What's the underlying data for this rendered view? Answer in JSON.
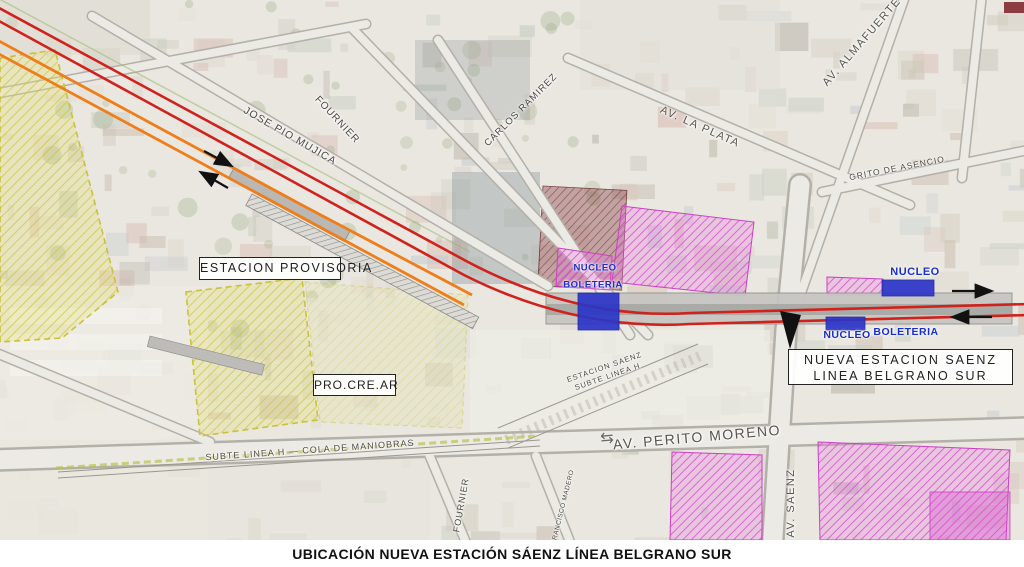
{
  "caption": "UBICACIÓN NUEVA ESTACIÓN SÁENZ LÍNEA BELGRANO SUR",
  "callouts": {
    "estacion_provisoria": "ESTACION PROVISORIA",
    "procrear": "PRO.CRE.AR",
    "nueva_estacion": {
      "line1": "NUEVA ESTACION SAENZ",
      "line2": "LINEA BELGRANO SUR"
    }
  },
  "station": {
    "nucleo_mid": "NUCLEO",
    "boleteria_mid": "BOLETERIA",
    "nucleo_right_top": "NUCLEO",
    "nucleo_right_bottom": "NUCLEO",
    "boleteria_right": "BOLETERIA"
  },
  "streets": {
    "jose_pio_mujica": "JOSE PIO MUJICA",
    "fournier_top": "FOURNIER",
    "carlos_ramirez": "CARLOS RAMIREZ",
    "av_la_plata": "AV. LA PLATA",
    "av_almafuerte": "AV. ALMAFUERTE",
    "grito_de_asencio": "GRITO DE ASENCIO",
    "subte_cola": "SUBTE LINEA H — COLA DE MANIOBRAS",
    "av_perito_moreno": "AV. PERITO MORENO",
    "fournier_bottom": "FOURNIER",
    "francisco_madero": "FRANCISCO MADERO",
    "av_saenz": "AV. SAENZ",
    "estacion_saenz_subte": {
      "line1": "ESTACION SAENZ",
      "line2": "SUBTE LINEA H"
    }
  },
  "icons": {
    "two_way_arrows": "⇆"
  },
  "colors": {
    "track_red": "#d0221c",
    "track_orange": "#ef7d1a",
    "station_blue": "#2b35c8",
    "label_blue": "#1a2ecb",
    "zone_magenta": "#d94fd0",
    "zone_yellow": "#c9c23a",
    "platform_gray": "#c7c6c2",
    "arrow_black": "#111111",
    "street_text": "#4c4a44",
    "caption_text": "#111111"
  }
}
